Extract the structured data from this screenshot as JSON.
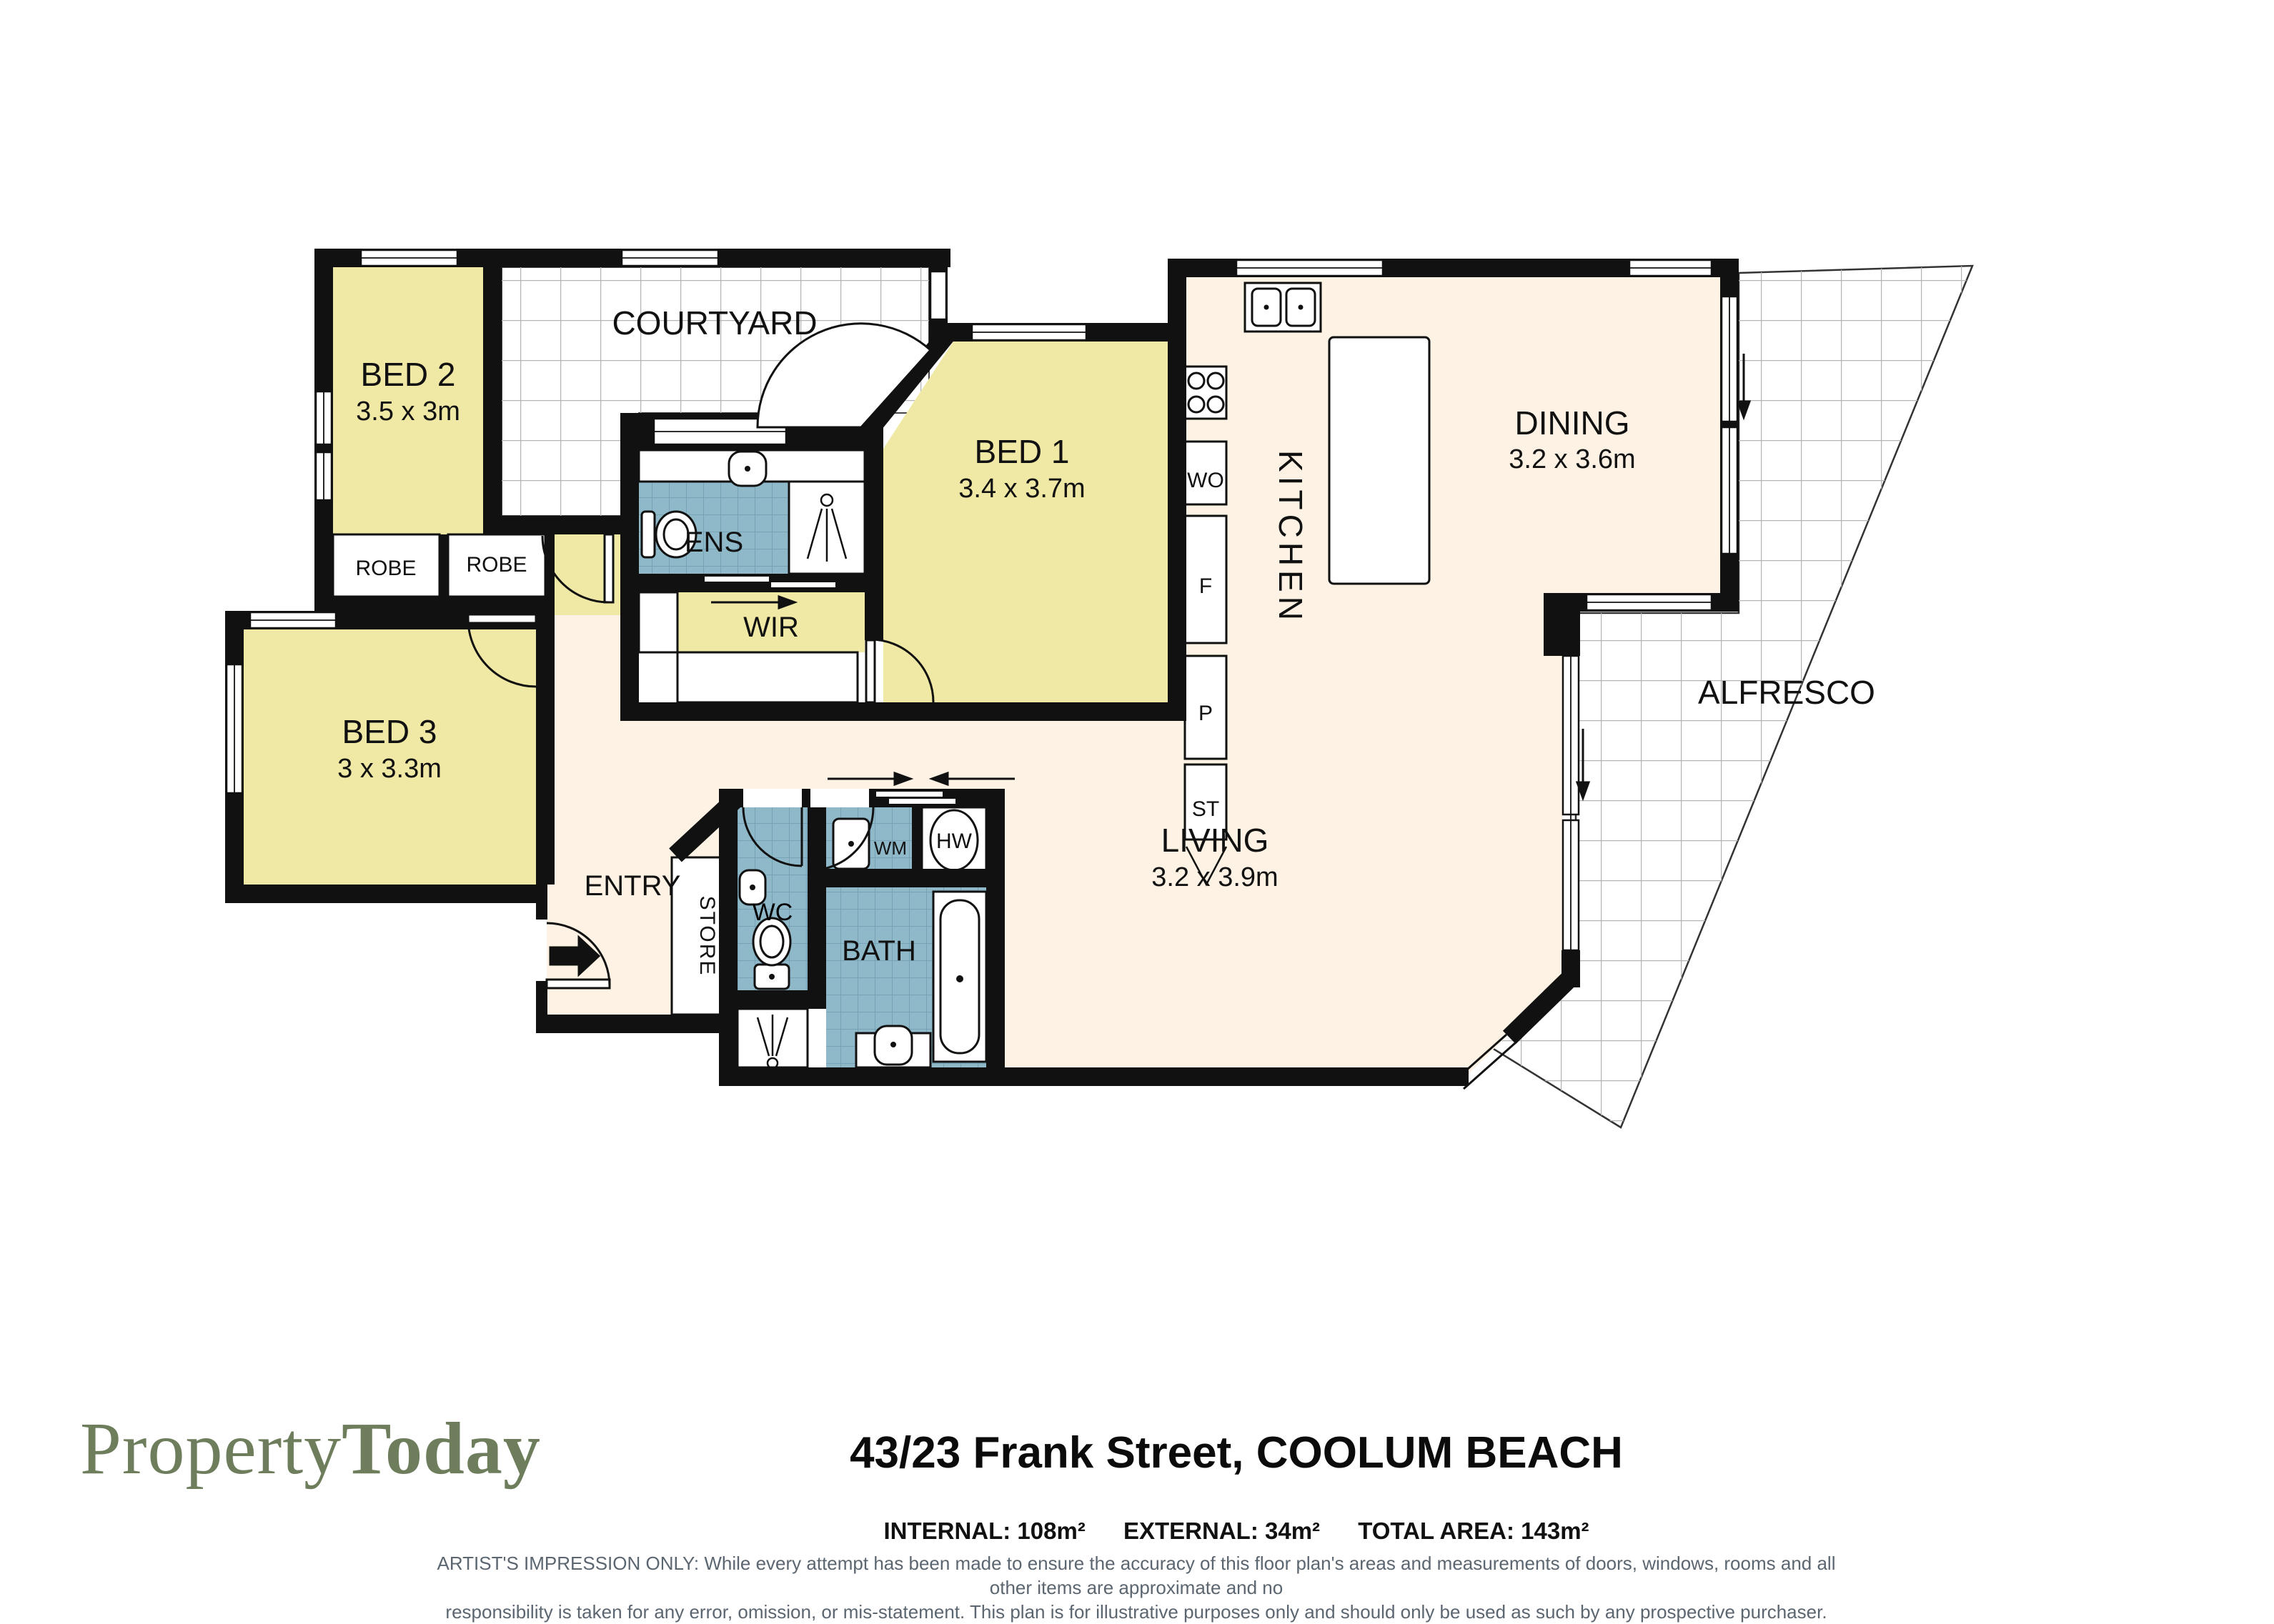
{
  "plan": {
    "courtyard": "COURTYARD",
    "alfresco": "ALFRESCO",
    "kitchen": "KITCHEN",
    "bed1": {
      "name": "BED 1",
      "dims": "3.4 x 3.7m"
    },
    "bed2": {
      "name": "BED 2",
      "dims": "3.5 x 3m"
    },
    "bed3": {
      "name": "BED 3",
      "dims": "3 x 3.3m"
    },
    "dining": {
      "name": "DINING",
      "dims": "3.2 x 3.6m"
    },
    "living": {
      "name": "LIVING",
      "dims": "3.2 x 3.9m"
    },
    "robes": [
      "ROBE",
      "ROBE"
    ],
    "ens": "ENS",
    "wir": "WIR",
    "entry": "ENTRY",
    "store": "STORE",
    "wc": "WC",
    "bath": "BATH",
    "wm": "WM",
    "hw": "HW",
    "wo": "WO",
    "f": "F",
    "p": "P",
    "st": "ST"
  },
  "footer": {
    "brand_light": "Property",
    "brand_bold": "Today",
    "address": "43/23 Frank Street, COOLUM BEACH",
    "area_internal": "INTERNAL: 108m²",
    "area_external": "EXTERNAL: 34m²",
    "area_total": "TOTAL AREA: 143m²",
    "disclaimer_line1": "ARTIST'S IMPRESSION ONLY: While every attempt has been made to ensure the accuracy of this floor plan's areas and measurements of doors, windows, rooms and all other items are approximate and no",
    "disclaimer_line2": "responsibility is taken for any error, omission, or mis-statement. This plan is for illustrative purposes only and should only be used as such by any prospective purchaser."
  },
  "colors": {
    "wall": "#111111",
    "bedroom_fill": "#f0e9a6",
    "floor_fill": "#fdf2e3",
    "wet_fill": "#8fb8c9",
    "outdoor_grid": "#b5b5b5",
    "brand_green": "#6e7e5c"
  }
}
